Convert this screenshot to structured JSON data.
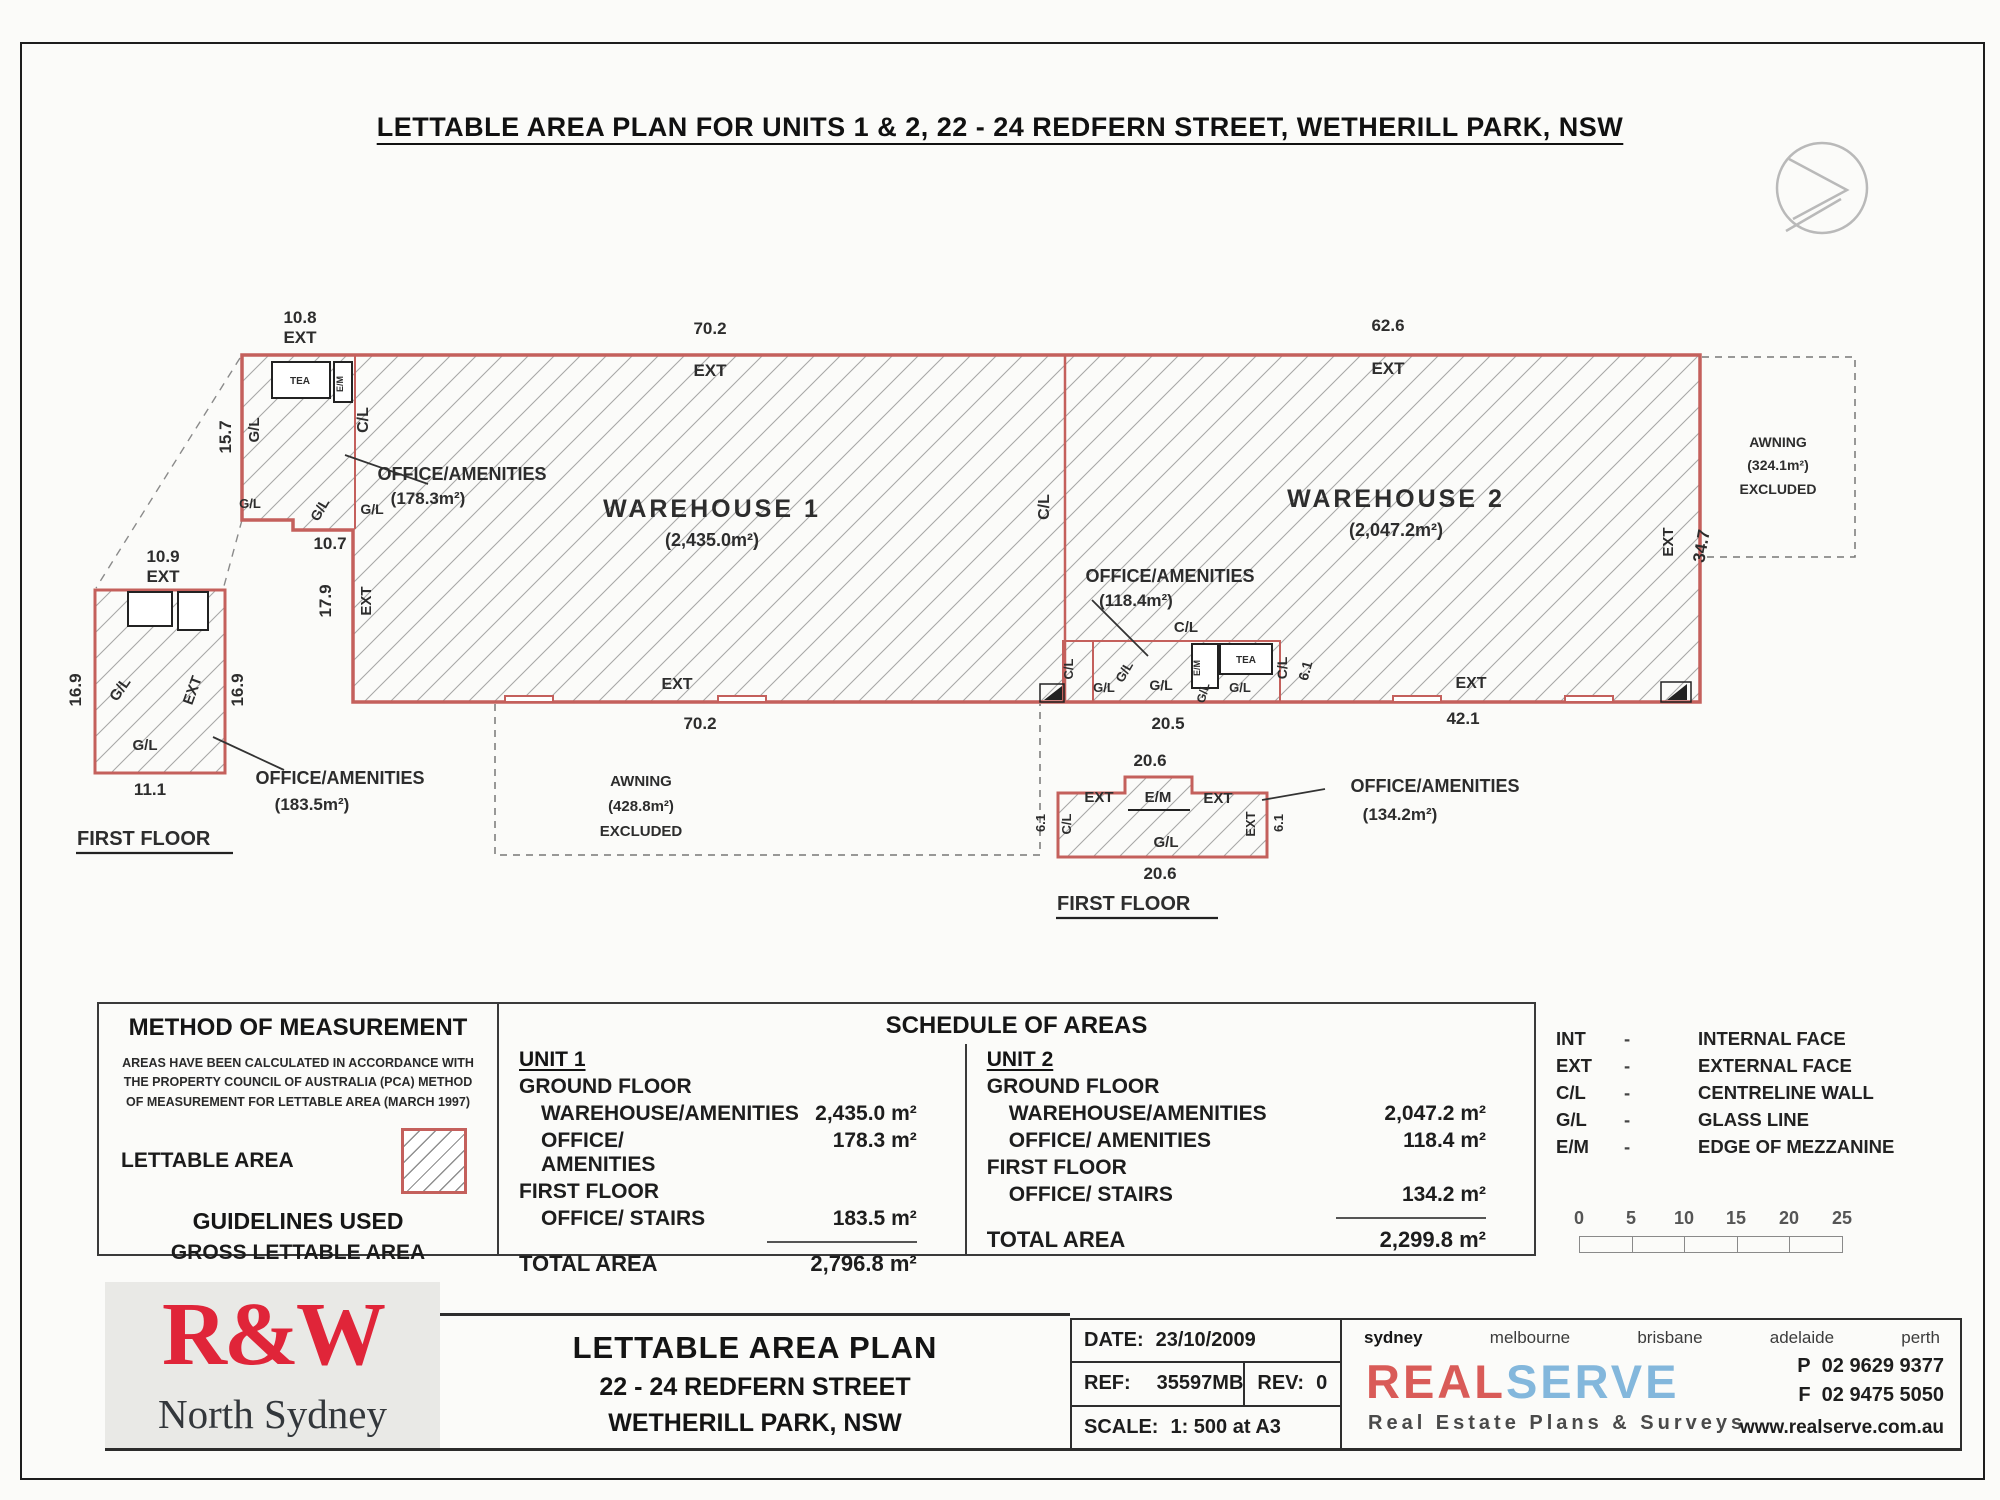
{
  "title": "LETTABLE AREA PLAN FOR UNITS 1 & 2, 22 - 24 REDFERN STREET, WETHERILL PARK, NSW",
  "colors": {
    "outline_red": "#c4605c",
    "hatch_gray": "#a7a7a7",
    "logo_red": "#e02539",
    "serve_blue": "#83b7dc"
  },
  "plan": {
    "labels": [
      {
        "t": "10.8",
        "x": 300,
        "y": 323,
        "n": "dim-10-8"
      },
      {
        "t": "EXT",
        "x": 300,
        "y": 343
      },
      {
        "t": "70.2",
        "x": 710,
        "y": 334,
        "n": "dim-70-2-top"
      },
      {
        "t": "EXT",
        "x": 710,
        "y": 376
      },
      {
        "t": "62.6",
        "x": 1388,
        "y": 331,
        "n": "dim-62-6"
      },
      {
        "t": "EXT",
        "x": 1388,
        "y": 374
      },
      {
        "t": "15.7",
        "x": 231,
        "y": 437,
        "r": -90,
        "n": "dim-15-7"
      },
      {
        "t": "G/L",
        "x": 259,
        "y": 430,
        "r": -90,
        "s": 15
      },
      {
        "t": "C/L",
        "x": 368,
        "y": 420,
        "r": -90,
        "s": 16
      },
      {
        "t": "G/L",
        "x": 250,
        "y": 508,
        "s": 13
      },
      {
        "t": "G/L",
        "x": 324,
        "y": 512,
        "r": -60,
        "s": 14
      },
      {
        "t": "G/L",
        "x": 372,
        "y": 514,
        "s": 14
      },
      {
        "t": "10.7",
        "x": 330,
        "y": 549,
        "n": "dim-10-7"
      },
      {
        "t": "OFFICE/AMENITIES",
        "x": 462,
        "y": 480,
        "s": 18,
        "n": "office1-label"
      },
      {
        "t": "(178.3m²)",
        "x": 428,
        "y": 504,
        "s": 17,
        "n": "office1-area"
      },
      {
        "t": "WAREHOUSE 1",
        "x": 712,
        "y": 517,
        "s": 25,
        "ls": 3,
        "n": "warehouse1-label"
      },
      {
        "t": "(2,435.0m²)",
        "x": 712,
        "y": 546,
        "s": 18,
        "n": "warehouse1-area"
      },
      {
        "t": "C/L",
        "x": 1049,
        "y": 507,
        "r": -90,
        "s": 16
      },
      {
        "t": "WAREHOUSE 2",
        "x": 1396,
        "y": 507,
        "s": 25,
        "ls": 3,
        "n": "warehouse2-label"
      },
      {
        "t": "(2,047.2m²)",
        "x": 1396,
        "y": 536,
        "s": 18,
        "n": "warehouse2-area"
      },
      {
        "t": "17.9",
        "x": 331,
        "y": 601,
        "r": -90,
        "n": "dim-17-9"
      },
      {
        "t": "EXT",
        "x": 371,
        "y": 601,
        "r": -90,
        "s": 15
      },
      {
        "t": "EXT",
        "x": 677,
        "y": 689,
        "s": 16
      },
      {
        "t": "70.2",
        "x": 700,
        "y": 729,
        "n": "dim-70-2-bottom"
      },
      {
        "t": "AWNING",
        "x": 641,
        "y": 786,
        "s": 15,
        "n": "awning1-label"
      },
      {
        "t": "(428.8m²)",
        "x": 641,
        "y": 811,
        "s": 15,
        "n": "awning1-area"
      },
      {
        "t": "EXCLUDED",
        "x": 641,
        "y": 836,
        "s": 15
      },
      {
        "t": "OFFICE/AMENITIES",
        "x": 1170,
        "y": 582,
        "s": 18,
        "n": "office2-label"
      },
      {
        "t": "(118.4m²)",
        "x": 1136,
        "y": 606,
        "s": 17,
        "n": "office2-area"
      },
      {
        "t": "C/L",
        "x": 1186,
        "y": 632,
        "s": 15
      },
      {
        "t": "C/L",
        "x": 1073,
        "y": 669,
        "r": -90,
        "s": 13
      },
      {
        "t": "G/L",
        "x": 1104,
        "y": 692,
        "s": 13
      },
      {
        "t": "G/L",
        "x": 1128,
        "y": 674,
        "r": -60,
        "s": 13
      },
      {
        "t": "G/L",
        "x": 1161,
        "y": 690,
        "s": 14
      },
      {
        "t": "G/L",
        "x": 1207,
        "y": 694,
        "r": -75,
        "s": 12
      },
      {
        "t": "G/L",
        "x": 1240,
        "y": 692,
        "s": 13
      },
      {
        "t": "TEA",
        "x": 1246,
        "y": 663,
        "s": 10,
        "n": "tea-room-label"
      },
      {
        "t": "E/M",
        "x": 1200,
        "y": 668,
        "r": -90,
        "s": 9
      },
      {
        "t": "C/L",
        "x": 1287,
        "y": 668,
        "r": -90,
        "s": 14
      },
      {
        "t": "6.1",
        "x": 1310,
        "y": 672,
        "r": -75,
        "s": 14,
        "n": "dim-6-1"
      },
      {
        "t": "20.5",
        "x": 1168,
        "y": 729,
        "n": "dim-20-5"
      },
      {
        "t": "EXT",
        "x": 1471,
        "y": 688,
        "s": 16
      },
      {
        "t": "42.1",
        "x": 1463,
        "y": 724,
        "n": "dim-42-1"
      },
      {
        "t": "EXT",
        "x": 1673,
        "y": 542,
        "r": -90,
        "s": 15
      },
      {
        "t": "34.7",
        "x": 1707,
        "y": 547,
        "r": -80,
        "n": "dim-34-7"
      },
      {
        "t": "AWNING",
        "x": 1778,
        "y": 447,
        "s": 14,
        "n": "awning2-label"
      },
      {
        "t": "(324.1m²)",
        "x": 1778,
        "y": 470,
        "s": 14,
        "n": "awning2-area"
      },
      {
        "t": "EXCLUDED",
        "x": 1778,
        "y": 494,
        "s": 14
      },
      {
        "t": "TEA",
        "x": 300,
        "y": 384,
        "s": 10,
        "n": "tea-room-label"
      },
      {
        "t": "E/M",
        "x": 343,
        "y": 384,
        "r": -90,
        "s": 9
      },
      {
        "t": "10.9",
        "x": 163,
        "y": 562,
        "n": "dim-10-9"
      },
      {
        "t": "EXT",
        "x": 163,
        "y": 582
      },
      {
        "t": "16.9",
        "x": 81,
        "y": 690,
        "r": -90,
        "n": "dim-16-9-left"
      },
      {
        "t": "16.9",
        "x": 243,
        "y": 690,
        "r": -90,
        "n": "dim-16-9-right"
      },
      {
        "t": "G/L",
        "x": 124,
        "y": 692,
        "r": -55,
        "s": 15
      },
      {
        "t": "EXT",
        "x": 197,
        "y": 692,
        "r": -70,
        "s": 15
      },
      {
        "t": "G/L",
        "x": 145,
        "y": 750,
        "s": 15
      },
      {
        "t": "11.1",
        "x": 150,
        "y": 795,
        "n": "dim-11-1"
      },
      {
        "t": "OFFICE/AMENITIES",
        "x": 340,
        "y": 784,
        "s": 18,
        "n": "ff1-office-label"
      },
      {
        "t": "(183.5m²)",
        "x": 312,
        "y": 810,
        "s": 17,
        "n": "ff1-office-area"
      },
      {
        "t": "FIRST FLOOR",
        "x": 77,
        "y": 845,
        "s": 20,
        "w": 800,
        "a": "start",
        "n": "ff1-title"
      },
      {
        "t": "20.6",
        "x": 1150,
        "y": 766,
        "n": "dim-20-6-top"
      },
      {
        "t": "EXT",
        "x": 1099,
        "y": 802,
        "s": 15
      },
      {
        "t": "C/L",
        "x": 1071,
        "y": 824,
        "r": -90,
        "s": 13
      },
      {
        "t": "E/M",
        "x": 1158,
        "y": 802,
        "s": 15
      },
      {
        "t": "EXT",
        "x": 1218,
        "y": 803,
        "s": 15
      },
      {
        "t": "EXT",
        "x": 1255,
        "y": 824,
        "r": -90,
        "s": 13
      },
      {
        "t": "6.1",
        "x": 1045,
        "y": 823,
        "r": -90,
        "s": 13
      },
      {
        "t": "6.1",
        "x": 1283,
        "y": 823,
        "r": -90,
        "s": 13
      },
      {
        "t": "G/L",
        "x": 1166,
        "y": 847,
        "s": 15
      },
      {
        "t": "20.6",
        "x": 1160,
        "y": 879,
        "n": "dim-20-6-bottom"
      },
      {
        "t": "OFFICE/AMENITIES",
        "x": 1435,
        "y": 792,
        "s": 18,
        "n": "ff2-office-label"
      },
      {
        "t": "(134.2m²)",
        "x": 1400,
        "y": 820,
        "s": 17,
        "n": "ff2-office-area"
      },
      {
        "t": "FIRST FLOOR",
        "x": 1057,
        "y": 910,
        "s": 20,
        "w": 800,
        "a": "start",
        "n": "ff2-title"
      }
    ]
  },
  "method": {
    "title": "METHOD OF MEASUREMENT",
    "body_lines": [
      "AREAS HAVE BEEN CALCULATED IN ACCORDANCE WITH",
      "THE PROPERTY COUNCIL OF AUSTRALIA (PCA) METHOD",
      "OF MEASUREMENT FOR LETTABLE AREA (MARCH 1997)"
    ],
    "swatch_label": "LETTABLE AREA",
    "guidelines_title": "GUIDELINES USED",
    "guidelines_value": "GROSS LETTABLE AREA"
  },
  "schedule": {
    "title": "SCHEDULE OF AREAS",
    "units": [
      {
        "name": "UNIT 1",
        "ground_heading": "GROUND FLOOR",
        "ground_rows": [
          {
            "label": "WAREHOUSE/AMENITIES",
            "value": "2,435.0 m²"
          },
          {
            "label": "OFFICE/ AMENITIES",
            "value": "178.3 m²"
          }
        ],
        "first_heading": "FIRST FLOOR",
        "first_rows": [
          {
            "label": "OFFICE/ STAIRS",
            "value": "183.5 m²"
          }
        ],
        "total_label": "TOTAL AREA",
        "total_value": "2,796.8 m²"
      },
      {
        "name": "UNIT 2",
        "ground_heading": "GROUND FLOOR",
        "ground_rows": [
          {
            "label": "WAREHOUSE/AMENITIES",
            "value": "2,047.2 m²"
          },
          {
            "label": "OFFICE/ AMENITIES",
            "value": "118.4 m²"
          }
        ],
        "first_heading": "FIRST FLOOR",
        "first_rows": [
          {
            "label": "OFFICE/ STAIRS",
            "value": "134.2 m²"
          }
        ],
        "total_label": "TOTAL AREA",
        "total_value": "2,299.8 m²"
      }
    ]
  },
  "legend": {
    "separator": "-",
    "items": [
      {
        "abbr": "INT",
        "desc": "INTERNAL FACE"
      },
      {
        "abbr": "EXT",
        "desc": "EXTERNAL FACE"
      },
      {
        "abbr": "C/L",
        "desc": "CENTRELINE WALL"
      },
      {
        "abbr": "G/L",
        "desc": "GLASS LINE"
      },
      {
        "abbr": "E/M",
        "desc": "EDGE OF MEZZANINE"
      }
    ]
  },
  "scale_bar": {
    "ticks": [
      "0",
      "5",
      "10",
      "15",
      "20",
      "25"
    ]
  },
  "titleblock": {
    "agency": {
      "logo": "R&W",
      "branch": "North Sydney"
    },
    "plan_title_lines": [
      "LETTABLE AREA PLAN",
      "22 - 24 REDFERN STREET",
      "WETHERILL PARK, NSW"
    ],
    "date_label": "DATE:",
    "date": "23/10/2009",
    "ref_label": "REF:",
    "ref": "35597MB",
    "rev_label": "REV:",
    "rev": "0",
    "scale_label": "SCALE:",
    "scale": "1: 500 at A3",
    "realserve": {
      "cities": [
        "sydney",
        "melbourne",
        "brisbane",
        "adelaide",
        "perth"
      ],
      "logo_real": "REAL",
      "logo_serve": "SERVE",
      "tagline": "Real Estate Plans & Surveys",
      "phone_label": "P",
      "phone": "02 9629 9377",
      "fax_label": "F",
      "fax": "02 9475 5050",
      "website": "www.realserve.com.au"
    }
  }
}
